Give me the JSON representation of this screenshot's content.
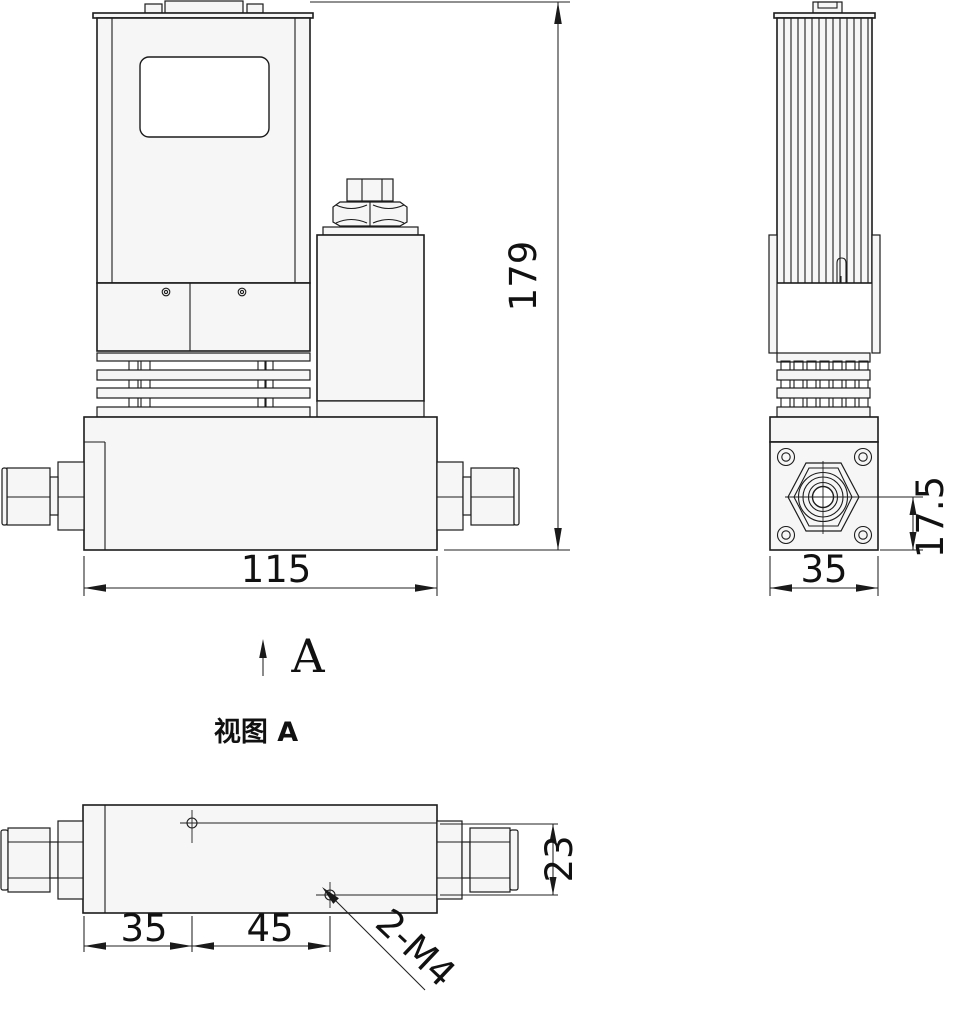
{
  "drawing": {
    "views": {
      "front": {
        "width": "115",
        "height": "179"
      },
      "side": {
        "width": "35",
        "port_center_to_bottom": "17.5"
      },
      "view_a": {
        "caption": "视图 A",
        "direction_label": "A",
        "edge_to_hole1": "35",
        "hole1_to_hole2": "45",
        "fitting_height": "23",
        "thread_callout": "2-M4"
      }
    }
  }
}
